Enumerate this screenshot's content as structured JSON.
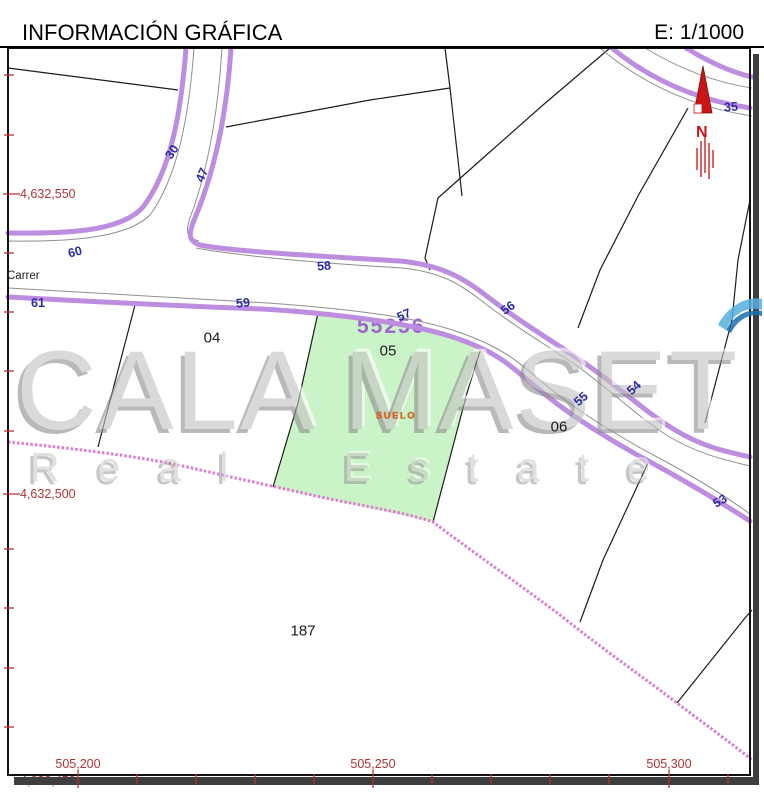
{
  "header": {
    "title": "INFORMACIÓN GRÁFICA",
    "scale_label": "E: 1/1000"
  },
  "watermark": {
    "line1": "CALA MASET",
    "line2": "Real Estate"
  },
  "map": {
    "street_name": "Carrer",
    "subject_parcel": {
      "ref": "55256",
      "land_use": "SUELO"
    },
    "north_indicator": {
      "letter": "N"
    },
    "parcel_numbers": [
      {
        "text": "04",
        "x": 212,
        "y": 338
      },
      {
        "text": "05",
        "x": 388,
        "y": 351
      },
      {
        "text": "06",
        "x": 559,
        "y": 427
      },
      {
        "text": "187",
        "x": 303,
        "y": 631
      }
    ],
    "road_numbers": [
      {
        "text": "30",
        "x": 172,
        "y": 152,
        "rot": -55
      },
      {
        "text": "47",
        "x": 202,
        "y": 175,
        "rot": -66
      },
      {
        "text": "60",
        "x": 75,
        "y": 252,
        "rot": -14
      },
      {
        "text": "61",
        "x": 38,
        "y": 303,
        "rot": 0
      },
      {
        "text": "58",
        "x": 324,
        "y": 266,
        "rot": -4
      },
      {
        "text": "59",
        "x": 243,
        "y": 303,
        "rot": -5
      },
      {
        "text": "57",
        "x": 404,
        "y": 315,
        "rot": -23
      },
      {
        "text": "56",
        "x": 508,
        "y": 308,
        "rot": -35
      },
      {
        "text": "55",
        "x": 581,
        "y": 399,
        "rot": -41
      },
      {
        "text": "54",
        "x": 634,
        "y": 388,
        "rot": -43
      },
      {
        "text": "53",
        "x": 720,
        "y": 501,
        "rot": -30
      },
      {
        "text": "35",
        "x": 731,
        "y": 107,
        "rot": -5
      }
    ],
    "grid": {
      "left_labels": [
        {
          "text": "4,632,550",
          "y": 194
        },
        {
          "text": "4,632,500",
          "y": 494
        },
        {
          "text": "4,632,450",
          "y": 781
        }
      ],
      "bottom_labels": [
        {
          "text": "505,200",
          "x": 78
        },
        {
          "text": "505,250",
          "x": 373
        },
        {
          "text": "505,300",
          "x": 669
        }
      ]
    }
  },
  "colors": {
    "road_edge_purple": "#bd8ddf",
    "curb_gray": "#8f8f8f",
    "boundary_pink": "#df7cd0",
    "parcel_green": "#cbf3c8",
    "grid_red": "#b53333",
    "road_number_blue": "#2a2aa5",
    "ref_purple": "#9e63cf",
    "suelo_orange": "#d2671c",
    "north_red": "#cc1414",
    "swoosh_blue": "#55aede"
  }
}
